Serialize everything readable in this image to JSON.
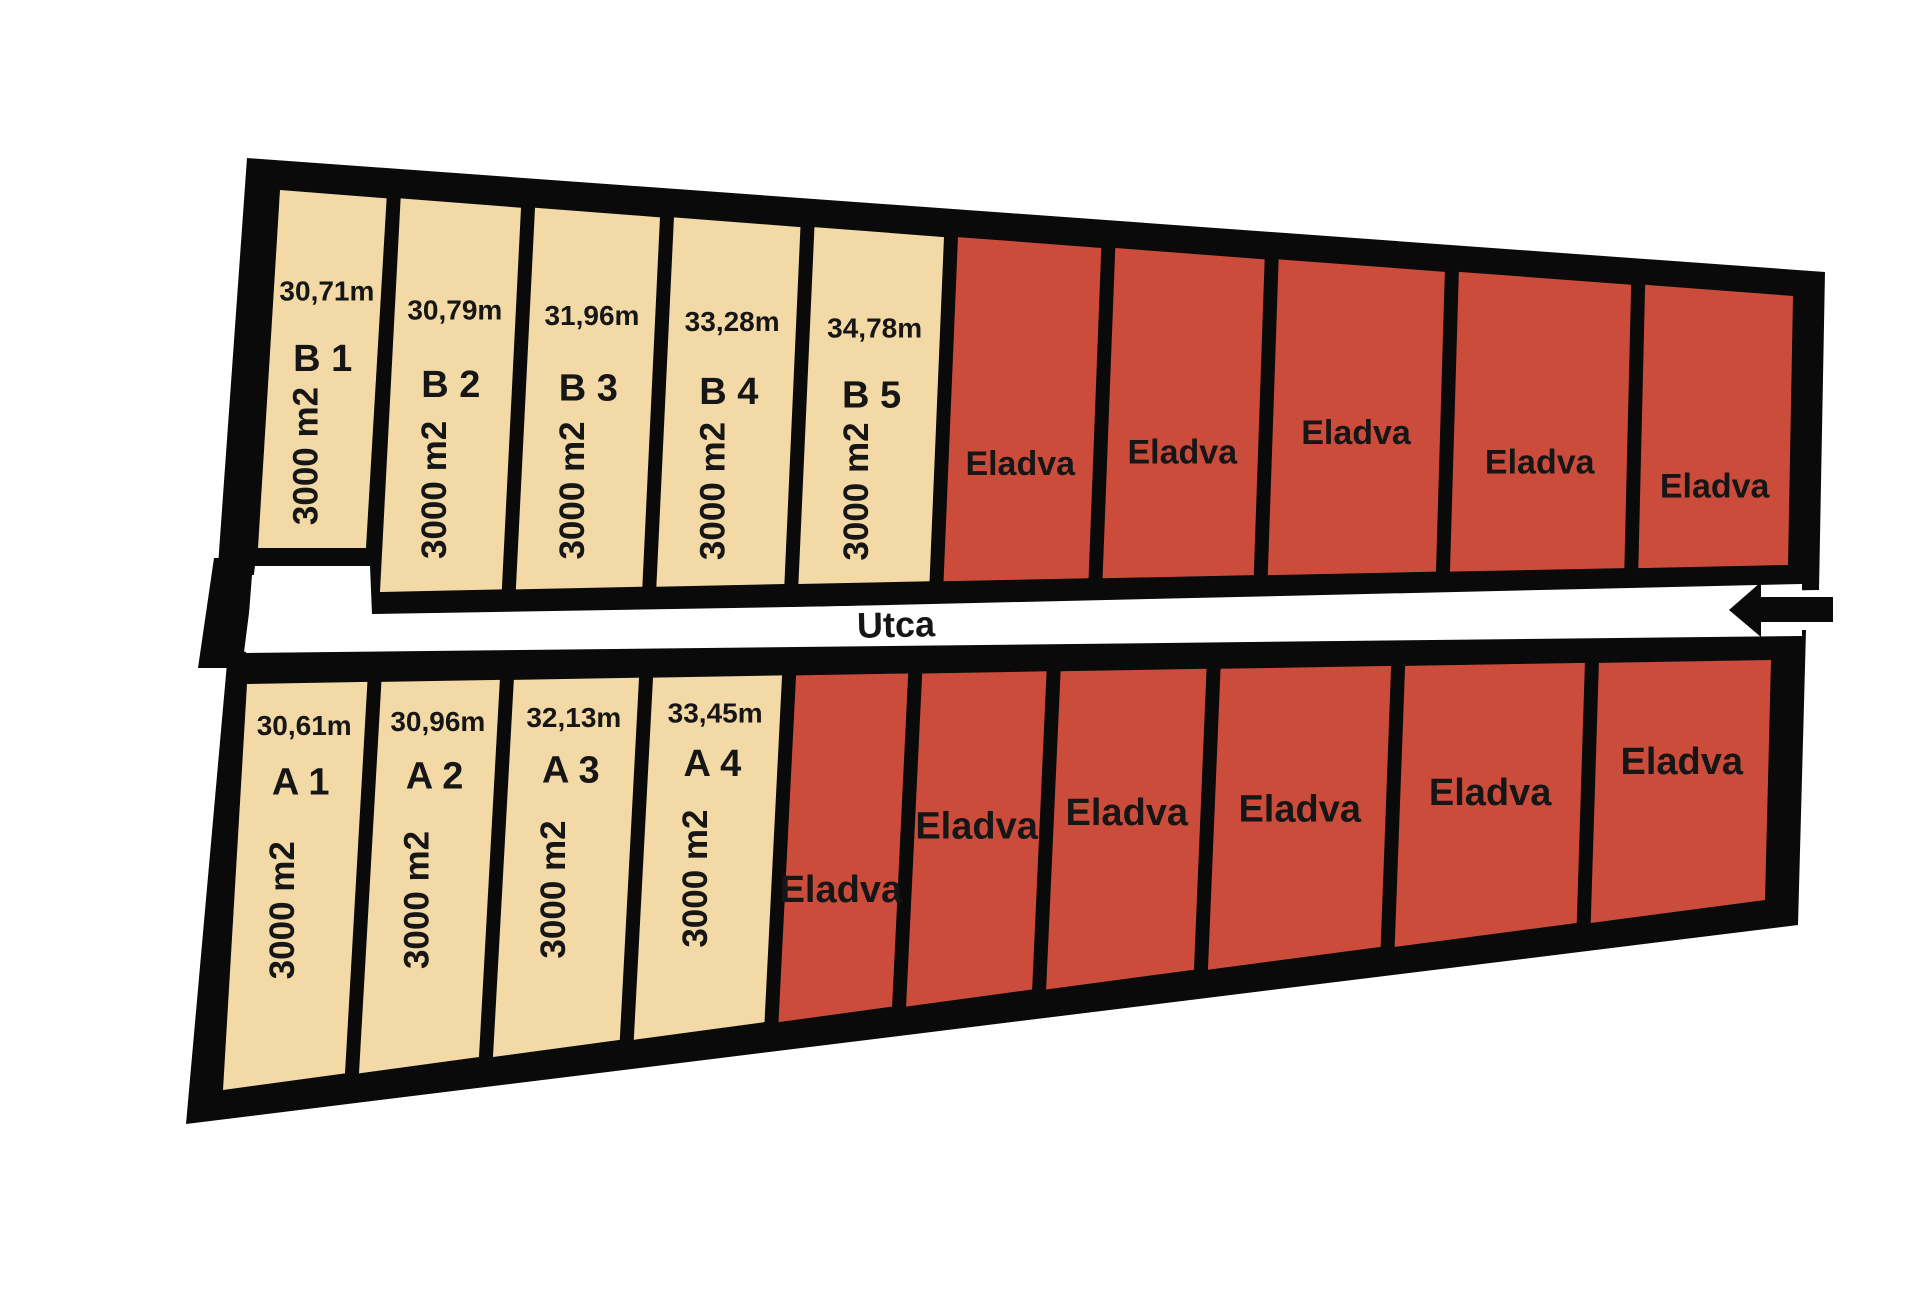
{
  "street": {
    "label": "Utca"
  },
  "sold_label": "Eladva",
  "colors": {
    "available_fill": "#F2D9A6",
    "sold_fill": "#CC4C3C",
    "outline": "#0A0A0A",
    "street_fill": "#FFFFFF",
    "text": "#161616"
  },
  "rows": {
    "top": {
      "id": "B",
      "plots": [
        {
          "status": "available",
          "name": "B 1",
          "frontage": "30,71m",
          "area": "3000 m2"
        },
        {
          "status": "available",
          "name": "B 2",
          "frontage": "30,79m",
          "area": "3000 m2"
        },
        {
          "status": "available",
          "name": "B 3",
          "frontage": "31,96m",
          "area": "3000 m2"
        },
        {
          "status": "available",
          "name": "B 4",
          "frontage": "33,28m",
          "area": "3000 m2"
        },
        {
          "status": "available",
          "name": "B 5",
          "frontage": "34,78m",
          "area": "3000 m2"
        },
        {
          "status": "sold"
        },
        {
          "status": "sold"
        },
        {
          "status": "sold"
        },
        {
          "status": "sold"
        },
        {
          "status": "sold"
        }
      ]
    },
    "bottom": {
      "id": "A",
      "plots": [
        {
          "status": "available",
          "name": "A 1",
          "frontage": "30,61m",
          "area": "3000 m2"
        },
        {
          "status": "available",
          "name": "A 2",
          "frontage": "30,96m",
          "area": "3000 m2"
        },
        {
          "status": "available",
          "name": "A 3",
          "frontage": "32,13m",
          "area": "3000 m2"
        },
        {
          "status": "available",
          "name": "A 4",
          "frontage": "33,45m",
          "area": "3000 m2"
        },
        {
          "status": "sold"
        },
        {
          "status": "sold"
        },
        {
          "status": "sold"
        },
        {
          "status": "sold"
        },
        {
          "status": "sold"
        },
        {
          "status": "sold"
        }
      ]
    }
  }
}
